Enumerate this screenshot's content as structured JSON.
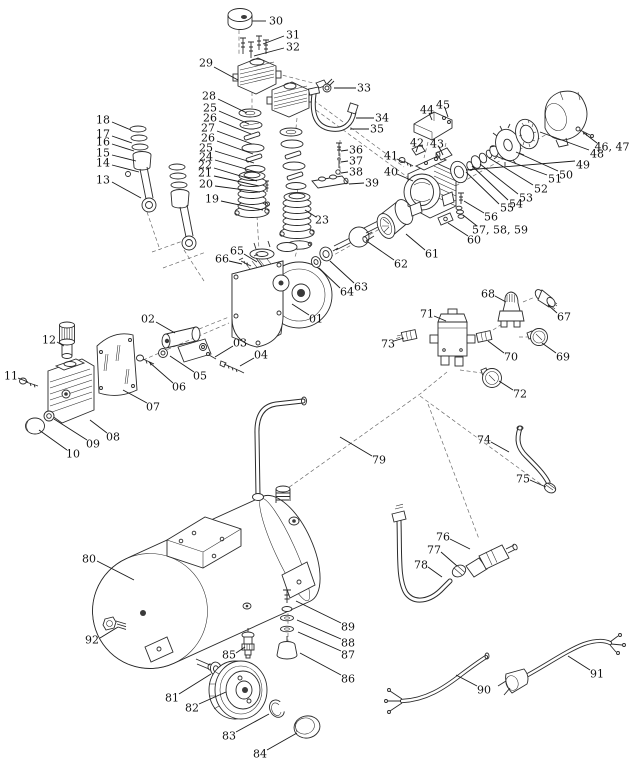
{
  "diagram": {
    "kind": "exploded-parts-diagram",
    "subject": "Air compressor exploded parts view",
    "background": "#ffffff",
    "line_color": "#2b2b2b",
    "label_color": "#111111",
    "label_font_size": 11,
    "labels": [
      {
        "text": "30",
        "x": 276,
        "y": 21,
        "line": [
          266,
          21,
          252,
          21
        ]
      },
      {
        "text": "31",
        "x": 293,
        "y": 35,
        "line": [
          284,
          36,
          263,
          44
        ]
      },
      {
        "text": "32",
        "x": 293,
        "y": 47,
        "line": [
          284,
          48,
          254,
          56
        ]
      },
      {
        "text": "29",
        "x": 206,
        "y": 63,
        "line": [
          214,
          67,
          238,
          80
        ]
      },
      {
        "text": "28",
        "x": 209,
        "y": 96,
        "line": [
          218,
          99,
          247,
          113
        ]
      },
      {
        "text": "25",
        "x": 210,
        "y": 108,
        "line": [
          219,
          111,
          249,
          124
        ]
      },
      {
        "text": "26",
        "x": 210,
        "y": 118,
        "line": [
          219,
          121,
          251,
          134
        ]
      },
      {
        "text": "27",
        "x": 208,
        "y": 128,
        "line": [
          217,
          131,
          252,
          144
        ]
      },
      {
        "text": "26",
        "x": 208,
        "y": 138,
        "line": [
          217,
          141,
          253,
          154
        ]
      },
      {
        "text": "25",
        "x": 206,
        "y": 148,
        "line": [
          215,
          151,
          254,
          163
        ]
      },
      {
        "text": "24",
        "x": 206,
        "y": 157,
        "line": [
          215,
          160,
          256,
          172
        ]
      },
      {
        "text": "22",
        "x": 205,
        "y": 165,
        "line": [
          214,
          168,
          257,
          181
        ]
      },
      {
        "text": "21",
        "x": 205,
        "y": 173,
        "line": [
          214,
          176,
          259,
          186
        ]
      },
      {
        "text": "20",
        "x": 206,
        "y": 184,
        "line": [
          215,
          186,
          260,
          192
        ]
      },
      {
        "text": "19",
        "x": 212,
        "y": 199,
        "line": [
          221,
          201,
          263,
          210
        ]
      },
      {
        "text": "18",
        "x": 103,
        "y": 120,
        "line": [
          112,
          122,
          131,
          130
        ]
      },
      {
        "text": "17",
        "x": 103,
        "y": 134,
        "line": [
          112,
          136,
          132,
          143
        ]
      },
      {
        "text": "16",
        "x": 103,
        "y": 142,
        "line": [
          112,
          144,
          134,
          151
        ]
      },
      {
        "text": "15",
        "x": 103,
        "y": 153,
        "line": [
          112,
          155,
          136,
          161
        ]
      },
      {
        "text": "14",
        "x": 103,
        "y": 163,
        "line": [
          112,
          165,
          139,
          172
        ]
      },
      {
        "text": "13",
        "x": 103,
        "y": 180,
        "line": [
          112,
          182,
          141,
          198
        ]
      },
      {
        "text": "23",
        "x": 322,
        "y": 220,
        "line": [
          316,
          217,
          305,
          210
        ]
      },
      {
        "text": "33",
        "x": 364,
        "y": 88,
        "line": [
          356,
          88,
          334,
          88
        ]
      },
      {
        "text": "34",
        "x": 382,
        "y": 118,
        "line": [
          374,
          118,
          356,
          118
        ]
      },
      {
        "text": "35",
        "x": 377,
        "y": 129,
        "line": [
          369,
          129,
          350,
          129
        ]
      },
      {
        "text": "36",
        "x": 356,
        "y": 150,
        "line": [
          348,
          150,
          341,
          151
        ]
      },
      {
        "text": "37",
        "x": 356,
        "y": 161,
        "line": [
          348,
          161,
          341,
          162
        ]
      },
      {
        "text": "38",
        "x": 356,
        "y": 172,
        "line": [
          348,
          172,
          341,
          173
        ]
      },
      {
        "text": "39",
        "x": 372,
        "y": 183,
        "line": [
          364,
          183,
          349,
          184
        ]
      },
      {
        "text": "41",
        "x": 391,
        "y": 156,
        "line": [
          397,
          159,
          405,
          163
        ]
      },
      {
        "text": "40",
        "x": 391,
        "y": 172,
        "line": [
          397,
          174,
          413,
          181
        ]
      },
      {
        "text": "42",
        "x": 417,
        "y": 143,
        "line": [
          418,
          146,
          416,
          152
        ]
      },
      {
        "text": "43",
        "x": 437,
        "y": 144,
        "line": [
          439,
          147,
          443,
          155
        ]
      },
      {
        "text": "44",
        "x": 427,
        "y": 110,
        "line": [
          429,
          113,
          432,
          120
        ]
      },
      {
        "text": "45",
        "x": 443,
        "y": 105,
        "line": [
          445,
          108,
          448,
          117
        ]
      },
      {
        "text": "46, 47",
        "x": 612,
        "y": 147,
        "line": [
          597,
          143,
          584,
          133
        ]
      },
      {
        "text": "48",
        "x": 597,
        "y": 154,
        "line": [
          589,
          150,
          540,
          132
        ]
      },
      {
        "text": "49",
        "x": 583,
        "y": 165,
        "line": [
          575,
          161,
          466,
          170
        ]
      },
      {
        "text": "50",
        "x": 566,
        "y": 175,
        "line": [
          558,
          171,
          516,
          152
        ]
      },
      {
        "text": "51",
        "x": 555,
        "y": 179,
        "line": [
          547,
          175,
          498,
          157
        ]
      },
      {
        "text": "52",
        "x": 541,
        "y": 189,
        "line": [
          533,
          185,
          489,
          158
        ]
      },
      {
        "text": "53",
        "x": 526,
        "y": 198,
        "line": [
          518,
          194,
          480,
          164
        ]
      },
      {
        "text": "54",
        "x": 516,
        "y": 204,
        "line": [
          508,
          200,
          472,
          166
        ]
      },
      {
        "text": "55",
        "x": 507,
        "y": 208,
        "line": [
          499,
          204,
          466,
          172
        ]
      },
      {
        "text": "56",
        "x": 491,
        "y": 217,
        "line": [
          484,
          213,
          464,
          201
        ]
      },
      {
        "text": "57, 58, 59",
        "x": 500,
        "y": 230,
        "line": [
          477,
          226,
          463,
          215
        ]
      },
      {
        "text": "60",
        "x": 474,
        "y": 240,
        "line": [
          468,
          236,
          448,
          223
        ]
      },
      {
        "text": "61",
        "x": 432,
        "y": 254,
        "line": [
          425,
          250,
          406,
          234
        ]
      },
      {
        "text": "62",
        "x": 401,
        "y": 264,
        "line": [
          394,
          260,
          368,
          242
        ]
      },
      {
        "text": "63",
        "x": 361,
        "y": 287,
        "line": [
          354,
          283,
          330,
          261
        ]
      },
      {
        "text": "64",
        "x": 347,
        "y": 292,
        "line": [
          340,
          288,
          319,
          268
        ]
      },
      {
        "text": "65",
        "x": 237,
        "y": 251,
        "line": [
          244,
          254,
          257,
          262
        ]
      },
      {
        "text": "66",
        "x": 222,
        "y": 259,
        "line": [
          229,
          261,
          242,
          264
        ]
      },
      {
        "text": "01",
        "x": 316,
        "y": 319,
        "line": [
          309,
          315,
          292,
          304
        ]
      },
      {
        "text": "02",
        "x": 148,
        "y": 319,
        "line": [
          156,
          322,
          175,
          333
        ]
      },
      {
        "text": "03",
        "x": 240,
        "y": 343,
        "line": [
          233,
          346,
          215,
          357
        ]
      },
      {
        "text": "04",
        "x": 261,
        "y": 355,
        "line": [
          254,
          358,
          240,
          366
        ]
      },
      {
        "text": "05",
        "x": 200,
        "y": 376,
        "line": [
          194,
          372,
          170,
          356
        ]
      },
      {
        "text": "06",
        "x": 179,
        "y": 387,
        "line": [
          173,
          383,
          149,
          362
        ]
      },
      {
        "text": "07",
        "x": 153,
        "y": 407,
        "line": [
          147,
          403,
          123,
          390
        ]
      },
      {
        "text": "08",
        "x": 113,
        "y": 437,
        "line": [
          107,
          433,
          90,
          420
        ]
      },
      {
        "text": "09",
        "x": 93,
        "y": 444,
        "line": [
          87,
          440,
          54,
          419
        ]
      },
      {
        "text": "10",
        "x": 73,
        "y": 454,
        "line": [
          67,
          450,
          39,
          430
        ]
      },
      {
        "text": "11",
        "x": 11,
        "y": 376,
        "line": [
          18,
          378,
          28,
          382
        ]
      },
      {
        "text": "12",
        "x": 49,
        "y": 340,
        "line": [
          57,
          342,
          64,
          346
        ]
      },
      {
        "text": "68",
        "x": 488,
        "y": 294,
        "line": [
          495,
          296,
          506,
          302
        ]
      },
      {
        "text": "67",
        "x": 564,
        "y": 317,
        "line": [
          557,
          313,
          548,
          305
        ]
      },
      {
        "text": "71",
        "x": 427,
        "y": 314,
        "line": [
          434,
          316,
          446,
          321
        ]
      },
      {
        "text": "73",
        "x": 388,
        "y": 344,
        "line": [
          394,
          341,
          404,
          338
        ]
      },
      {
        "text": "70",
        "x": 511,
        "y": 357,
        "line": [
          504,
          353,
          488,
          341
        ]
      },
      {
        "text": "69",
        "x": 563,
        "y": 357,
        "line": [
          556,
          353,
          542,
          343
        ]
      },
      {
        "text": "72",
        "x": 520,
        "y": 394,
        "line": [
          513,
          390,
          499,
          381
        ]
      },
      {
        "text": "74",
        "x": 484,
        "y": 440,
        "line": [
          491,
          442,
          509,
          452
        ]
      },
      {
        "text": "75",
        "x": 523,
        "y": 479,
        "line": [
          530,
          480,
          546,
          487
        ]
      },
      {
        "text": "76",
        "x": 443,
        "y": 537,
        "line": [
          450,
          539,
          470,
          549
        ]
      },
      {
        "text": "77",
        "x": 434,
        "y": 550,
        "line": [
          441,
          552,
          457,
          566
        ]
      },
      {
        "text": "78",
        "x": 421,
        "y": 565,
        "line": [
          428,
          567,
          442,
          577
        ]
      },
      {
        "text": "79",
        "x": 379,
        "y": 460,
        "line": [
          372,
          456,
          340,
          437
        ]
      },
      {
        "text": "80",
        "x": 89,
        "y": 559,
        "line": [
          97,
          561,
          134,
          580
        ]
      },
      {
        "text": "92",
        "x": 92,
        "y": 640,
        "line": [
          100,
          638,
          118,
          627
        ]
      },
      {
        "text": "85",
        "x": 229,
        "y": 655,
        "line": [
          236,
          653,
          245,
          647
        ]
      },
      {
        "text": "81",
        "x": 172,
        "y": 698,
        "line": [
          179,
          694,
          211,
          674
        ]
      },
      {
        "text": "82",
        "x": 192,
        "y": 708,
        "line": [
          199,
          704,
          226,
          692
        ]
      },
      {
        "text": "83",
        "x": 229,
        "y": 736,
        "line": [
          236,
          732,
          269,
          714
        ]
      },
      {
        "text": "84",
        "x": 260,
        "y": 754,
        "line": [
          267,
          750,
          297,
          733
        ]
      },
      {
        "text": "86",
        "x": 348,
        "y": 679,
        "line": [
          341,
          675,
          300,
          653
        ]
      },
      {
        "text": "87",
        "x": 348,
        "y": 655,
        "line": [
          341,
          651,
          298,
          632
        ]
      },
      {
        "text": "88",
        "x": 348,
        "y": 643,
        "line": [
          341,
          639,
          297,
          620
        ]
      },
      {
        "text": "89",
        "x": 348,
        "y": 627,
        "line": [
          341,
          623,
          296,
          601
        ]
      },
      {
        "text": "90",
        "x": 484,
        "y": 690,
        "line": [
          477,
          686,
          456,
          675
        ]
      },
      {
        "text": "91",
        "x": 597,
        "y": 674,
        "line": [
          590,
          670,
          568,
          656
        ]
      }
    ]
  }
}
